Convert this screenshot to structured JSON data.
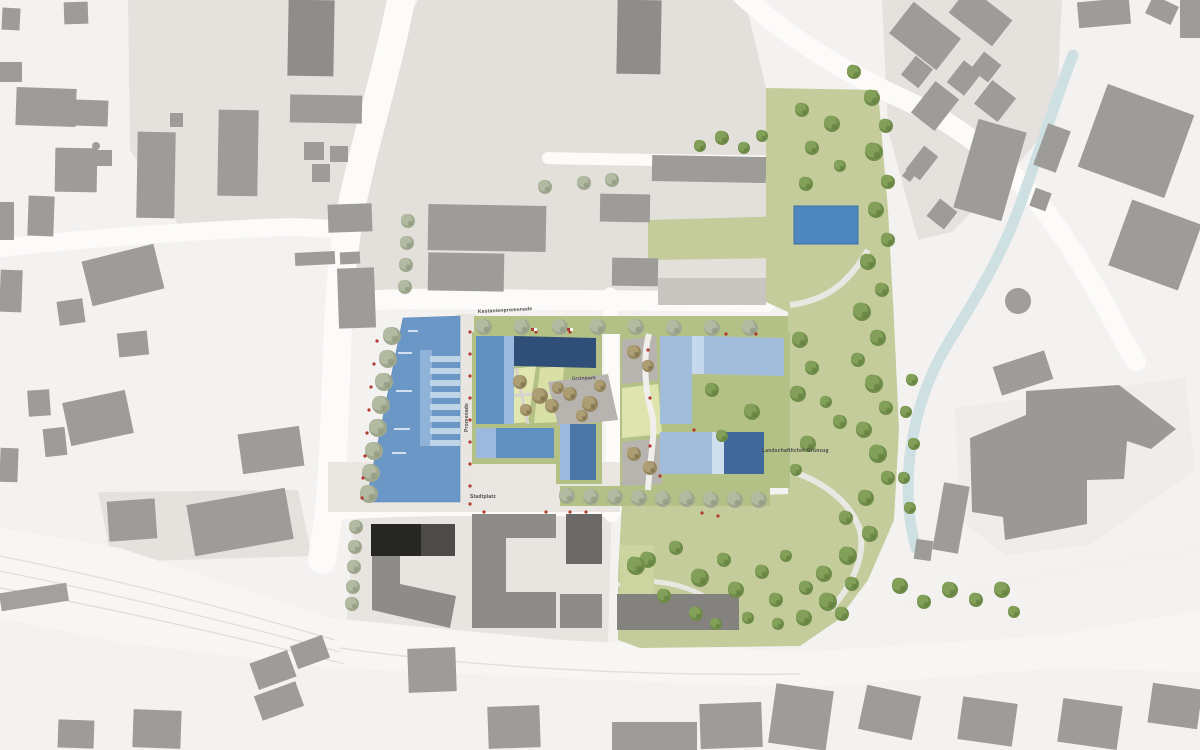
{
  "map": {
    "type": "architectural-site-plan",
    "labels": {
      "north_street": "Kastanienpromenade",
      "west_promenade": "Promenade",
      "central_courtyard": "Grünpark",
      "landscape_park": "Landschaftlicher Grünzug",
      "south_plaza": "Stadtplatz"
    },
    "palette": {
      "background": "#f4f2f0",
      "block_pad": "#e5e2de",
      "road": "#fcfbfa",
      "context_building": "#9e9c99",
      "context_building_dark": "#6b6967",
      "context_building_black": "#262624",
      "site_paving": "#eae7e3",
      "green_band": "#b4c186",
      "park_green": "#c4cc9b",
      "lawn": "#e0e5ad",
      "grove_plaza": "#b7b4af",
      "blue_building_main": "#6b97c6",
      "blue_building_navy": "#2f4f78",
      "blue_building_medium": "#6090c0",
      "blue_building_light": "#a2bddc",
      "blue_building_dark_wing": "#40689a",
      "roof_stripe_light": "#bdd3e7",
      "pond_blue": "#4e86c0",
      "stream": "#cfe0e3",
      "marker_red": "#b03a2e",
      "tree_olive": "#6f8c49",
      "tree_sage": "#9fa88f",
      "tree_khaki": "#96875f"
    },
    "feature_names": [
      "existing-context-buildings",
      "planned-buildings-blue-roofs",
      "central-courtyard-block",
      "landscape-park-with-trees",
      "stream",
      "pond",
      "street-tree-rows",
      "railway-road-corridor",
      "roundabout"
    ]
  }
}
